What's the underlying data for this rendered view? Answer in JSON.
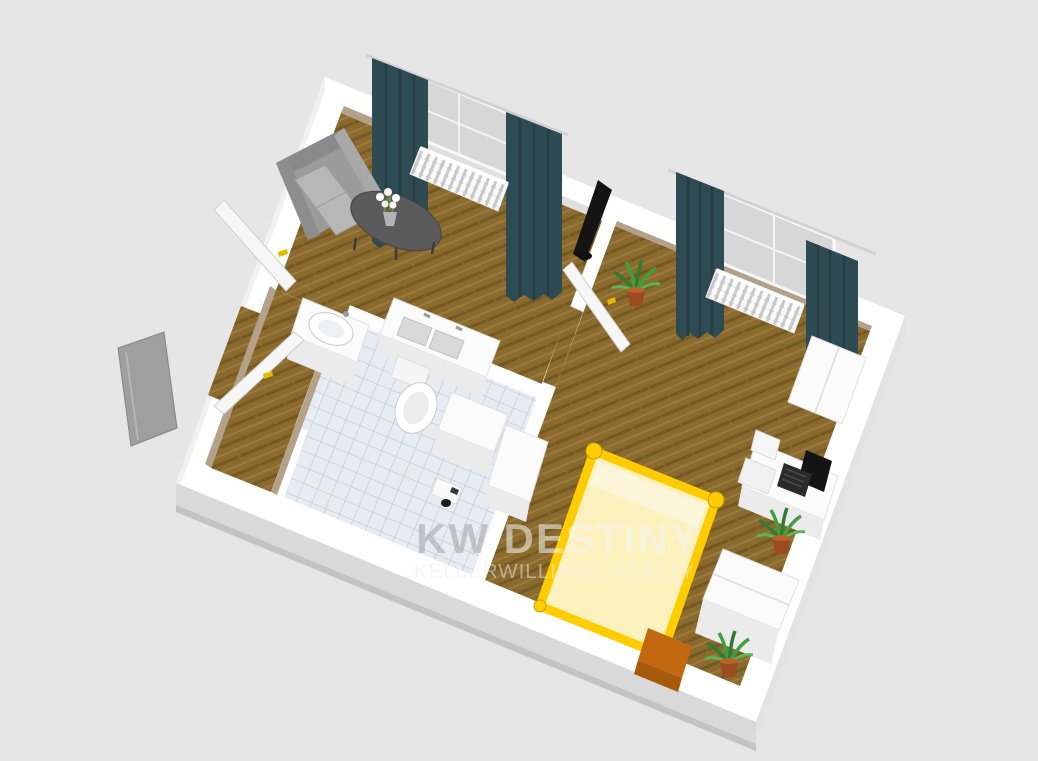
{
  "scene": {
    "type": "3d-floor-plan-render",
    "description": "Aerial 3D rendering of a one-bedroom apartment floor plan with living room, bedroom, bathroom and entrance hall",
    "background": "#e6e6e6"
  },
  "watermark": {
    "line1_prefix": "KW",
    "line1_suffix": " DESTINY",
    "line2": "KELLERWILLIAMS REALTY"
  },
  "palette": {
    "background": "#e6e6e6",
    "wall_white": "#ffffff",
    "wall_shadow": "#d9d9d9",
    "wall_tan": "#b3a189",
    "wood_floor": "#8a6a2e",
    "wood_floor_dark": "#75591f",
    "wood_floor_light": "#9c7b3a",
    "tile": "#e7ecf3",
    "tile_line": "#c3cdde",
    "curtain": "#2e4a52",
    "sofa": "#9b9b9b",
    "sofa_cushion": "#b7b7b7",
    "table": "#5b5b5b",
    "bed_frame": "#ffcc00",
    "bed_mattress": "#fdf2bd",
    "bed_pillow": "#fbf6d9",
    "chest_orange": "#c2690f",
    "plant_green": "#3fa03f",
    "plant_pot": "#9c4a1f",
    "laptop": "#141414",
    "fixture_white": "#fbfbfb",
    "door_handle": "#e3b900",
    "entry_door_gray": "#9f9f9f"
  },
  "rooms": [
    {
      "name": "living-room",
      "floor": "wood-herringbone"
    },
    {
      "name": "bedroom",
      "floor": "wood-herringbone"
    },
    {
      "name": "bathroom",
      "floor": "blue-tile"
    },
    {
      "name": "entrance-hall",
      "floor": "wood"
    }
  ],
  "furniture": [
    "sofa",
    "coffee-table",
    "flower-vase",
    "tv",
    "window-curtains",
    "radiator",
    "double-bed",
    "bedside-chest",
    "desk",
    "laptop",
    "chair",
    "wardrobe",
    "dresser",
    "washbasin-cabinet",
    "double-sink-counter",
    "toilet",
    "bathroom-cabinet",
    "potted-plant",
    "interior-doors",
    "entrance-door"
  ]
}
